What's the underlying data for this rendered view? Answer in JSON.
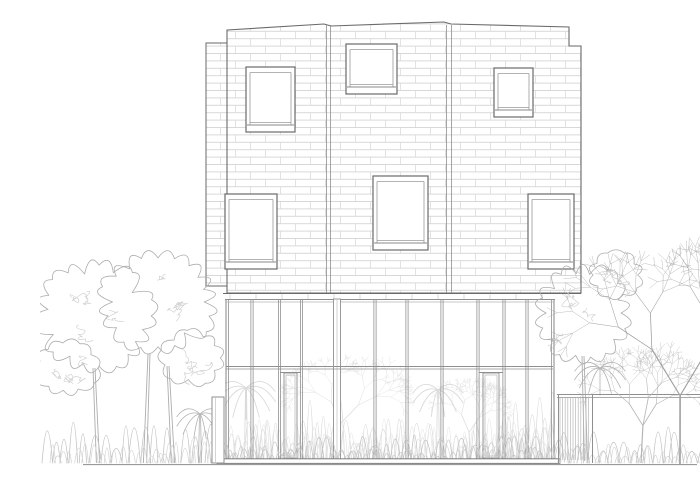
{
  "meta": {
    "description": "Architectural front elevation line drawing: brick-clad upper volume with six punched windows over a fully glazed ground floor with two doors, flanked by leafy and bare trees, shrubs and a garden fence"
  },
  "canvas": {
    "w": 700,
    "h": 468
  },
  "colors": {
    "background": "#ffffff",
    "outline": "#6a6a6a",
    "frame_light": "#9a9a9a",
    "glass_line": "#8f8f8f",
    "brick_line": "#cbcbcb",
    "brick_joint": "#d7d7d7",
    "tick": "#c9c9c9",
    "veg_outline": "#adadad",
    "veg_scribble": "#d2d2d2",
    "veg_front": "#c3c3c3",
    "veg_interior": "#dadada",
    "bare_tree": "#a0a0a0",
    "fence_hatch": "#b8b8b8",
    "ground": "#9a9a9a"
  },
  "building": {
    "upper_outline": [
      [
        187,
        14
      ],
      [
        284,
        8
      ],
      [
        291,
        10
      ],
      [
        404,
        6
      ],
      [
        411,
        8
      ],
      [
        529,
        11
      ],
      [
        529,
        30
      ],
      [
        541,
        30
      ],
      [
        541,
        277
      ],
      [
        187,
        277
      ]
    ],
    "left_wing": {
      "x": 166,
      "y": 27,
      "w": 21,
      "h": 243
    },
    "panel_joints_x": [
      286.5,
      290.5,
      406.5,
      411.5
    ],
    "brick": {
      "course_h": 7.4,
      "brick_len": 30
    },
    "window_count": 6,
    "windows": [
      {
        "id": "upper-left",
        "x": 206,
        "y": 51,
        "w": 49,
        "h": 65
      },
      {
        "id": "upper-middle",
        "x": 306,
        "y": 28,
        "w": 51,
        "h": 50
      },
      {
        "id": "upper-right",
        "x": 454,
        "y": 52,
        "w": 39,
        "h": 49
      },
      {
        "id": "mid-left",
        "x": 185,
        "y": 178,
        "w": 52,
        "h": 75
      },
      {
        "id": "mid-center",
        "x": 333,
        "y": 160,
        "w": 55,
        "h": 74
      },
      {
        "id": "mid-right",
        "x": 488,
        "y": 178,
        "w": 46,
        "h": 75
      }
    ]
  },
  "ground_floor": {
    "glass": {
      "x": 185,
      "y": 283,
      "w": 330,
      "h": 160
    },
    "band_y": [
      277.5,
      283.5
    ],
    "head_line_y": 286,
    "transom_y": [
      350.5,
      353
    ],
    "edge_left_x": [
      186,
      188.5
    ],
    "edge_right_x": [
      511.5,
      514
    ],
    "mullions_x": [
      212,
      239.5,
      261.5,
      335,
      367,
      402,
      438,
      464,
      487
    ],
    "pier": {
      "x": 293.5,
      "w": 7
    },
    "door_count": 2,
    "doors": [
      {
        "x": 244,
        "y": 357,
        "w": 13,
        "h": 85,
        "head_x1": 240,
        "head_x2": 261
      },
      {
        "x": 443,
        "y": 357,
        "w": 16,
        "h": 85,
        "head_x1": 439,
        "head_x2": 463
      }
    ],
    "slab": {
      "x": 177,
      "y": 442.8,
      "w": 343,
      "h": 4.6
    }
  },
  "site": {
    "ground_line": {
      "x1": 43,
      "y": 448.6,
      "x2": 657
    },
    "fence": {
      "x1": 517,
      "x2": 660,
      "rail_y1": 378.5,
      "rail_y2": 381.5,
      "hatch_x1": 520,
      "hatch_x2": 551,
      "hatch_top": 382,
      "hatch_bottom": 444,
      "post1_x": 518.5,
      "post2_x": 552.5,
      "post_bottom": 447
    },
    "left_wall": {
      "x": 172,
      "y": 381,
      "w": 12,
      "h": 66
    }
  },
  "vegetation": {
    "left_clouds": [
      {
        "cx": 55,
        "cy": 300,
        "rx": 54,
        "ry": 50
      },
      {
        "cx": 118,
        "cy": 286,
        "rx": 54,
        "ry": 46
      },
      {
        "cx": 27,
        "cy": 352,
        "rx": 30,
        "ry": 26
      },
      {
        "cx": 152,
        "cy": 342,
        "rx": 30,
        "ry": 26
      }
    ],
    "left_trunks": [
      [
        58,
        447,
        54,
        352
      ],
      [
        105,
        447,
        109,
        338
      ],
      [
        133,
        447,
        128,
        350
      ]
    ],
    "left_shrubs": {
      "x1": 2,
      "x2": 178,
      "base": 447,
      "max_h": 46
    },
    "left_palm": {
      "cx": 160,
      "cy": 398,
      "r": 24,
      "fronds": 8
    },
    "right_clouds": [
      {
        "cx": 543,
        "cy": 297,
        "rx": 44,
        "ry": 45
      },
      {
        "cx": 576,
        "cy": 259,
        "rx": 26,
        "ry": 22
      }
    ],
    "right_trunks": [
      [
        546,
        445,
        543,
        340
      ]
    ],
    "right_palm": {
      "cx": 560,
      "cy": 352,
      "r": 26,
      "fronds": 9
    },
    "right_shrubs": {
      "x1": 518,
      "x2": 658,
      "base": 447,
      "max_h": 40
    },
    "bare_tree": {
      "x": 640,
      "ground": 449,
      "top": 232,
      "seed": 11
    },
    "bare_tree_small": {
      "x": 601,
      "ground": 447,
      "top": 330,
      "seed": 4
    },
    "interior_palms": [
      {
        "cx": 206,
        "cy": 372,
        "r": 30,
        "fronds": 9
      },
      {
        "cx": 398,
        "cy": 374,
        "r": 26,
        "fronds": 8
      }
    ],
    "interior_trees": [
      {
        "x": 300,
        "ground": 442,
        "top": 333,
        "seed": 5
      },
      {
        "x": 430,
        "ground": 442,
        "top": 362,
        "seed": 9
      }
    ],
    "interior_shrubs": {
      "x1": 187,
      "x2": 513,
      "base": 442,
      "max_h": 44
    },
    "front_shrubs": {
      "x1": 180,
      "x2": 518,
      "base": 446,
      "max_h": 30
    }
  }
}
